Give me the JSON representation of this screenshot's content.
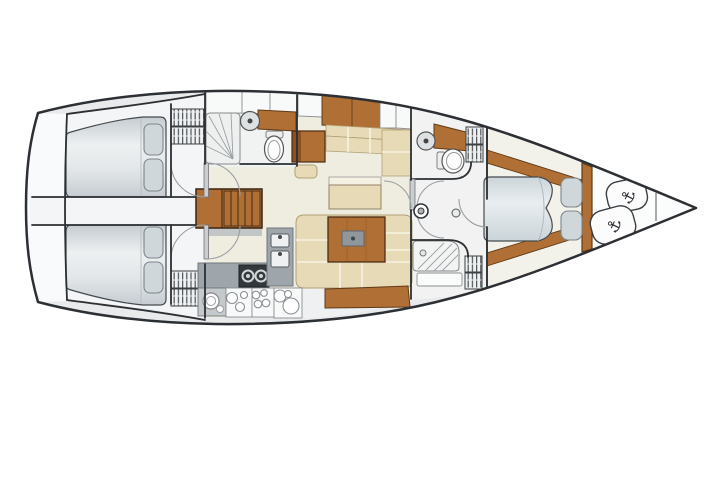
{
  "diagram": {
    "type": "sailing-yacht-interior-floor-plan",
    "orientation": "bow-right",
    "icons": {
      "anchor": "⚓"
    },
    "palette": {
      "background": "#ffffff",
      "outline": "#2c2f33",
      "deck": "#e8eaec",
      "hull-white": "#f9fafb",
      "floor-cream": "#efede0",
      "floor-white": "#f4f5f6",
      "wood": "#b06f35",
      "wood-dark": "#8a5122",
      "wood-edge": "#5f3a16",
      "cushion": "#e7dab6",
      "cushion-edge": "#b1a075",
      "mattress-light": "#edf0f1",
      "mattress-dark": "#c5ccd1",
      "fwd-mattress-light": "#e9eef0",
      "fwd-mattress-dark": "#cbd4d9",
      "pillow": "#cfd7db",
      "pillow-edge": "#7d868c",
      "counter": "#9ea6ab",
      "appliance": "#33383c",
      "metal": "#dde1e3",
      "arc": "#999fa3",
      "stripe": "#4e5457"
    }
  }
}
